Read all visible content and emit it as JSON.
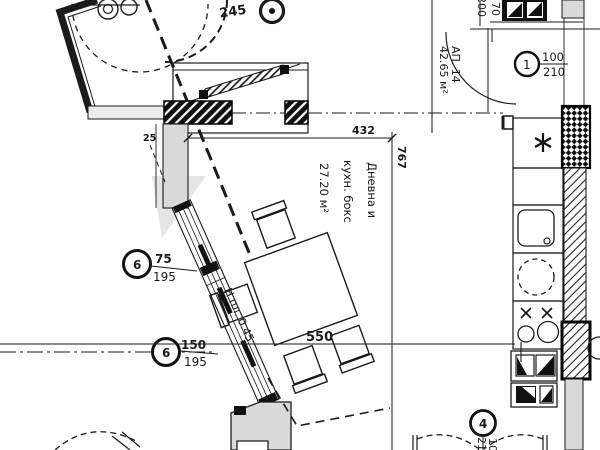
{
  "drawing": {
    "title": "apartment-floor-plan",
    "apartment": {
      "label": "АП. 14",
      "area": "42.65 м²"
    },
    "room": {
      "name_line1": "Дневна и",
      "name_line2": "кухн. бокс",
      "area": "27.20 м²"
    },
    "note_parapet": "Н.пл. 0.45",
    "dimensions": {
      "d245": "245",
      "d432": "432",
      "d767": "767",
      "d550": "550",
      "d25": "25"
    },
    "markers": {
      "door1": {
        "no": "1",
        "w": "100",
        "h": "210"
      },
      "win6a": {
        "no": "6",
        "w": "75",
        "h": "195"
      },
      "win6b": {
        "no": "6",
        "w": "150",
        "h": "195"
      },
      "door4": {
        "no": "4",
        "w": "100",
        "h": "210"
      },
      "door_top": {
        "w": "70",
        "h": "200"
      }
    },
    "colors": {
      "line": "#1b1b1b",
      "wall_gray": "#d9d9d9",
      "bg": "#ffffff"
    }
  }
}
